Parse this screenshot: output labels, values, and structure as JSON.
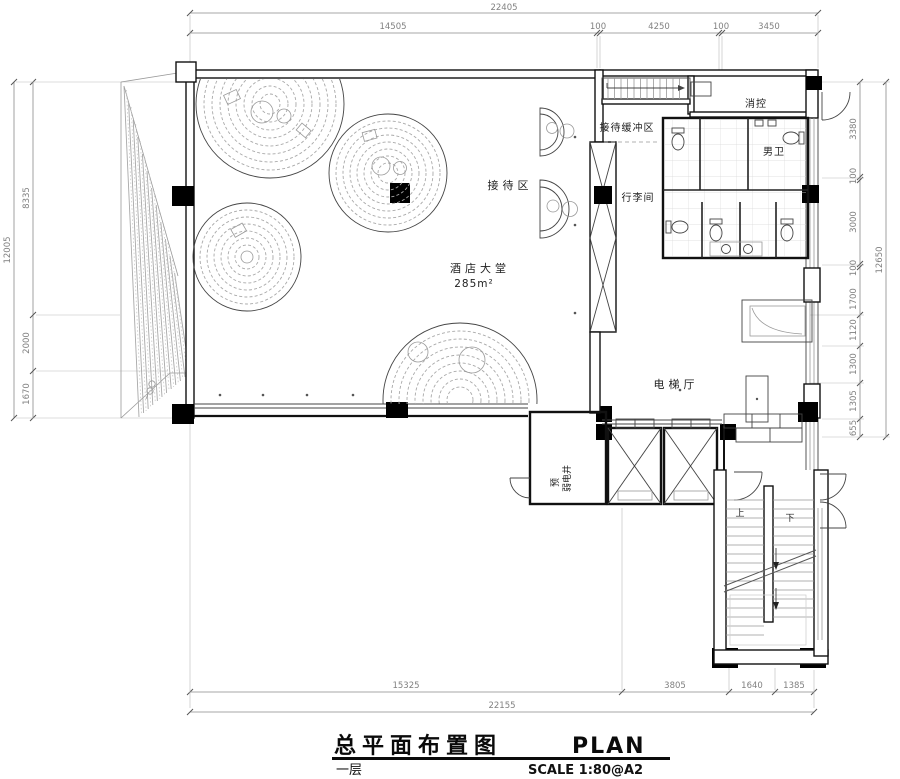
{
  "title_block": {
    "title_cn": "总平面布置图",
    "title_en": "PLAN",
    "floor_label": "一层",
    "scale_label": "SCALE  1:80@A2"
  },
  "rooms": {
    "lobby": "酒店大堂",
    "lobby_area": "285m²",
    "reception": "接待区",
    "reception_buffer": "接待缓冲区",
    "fire_control": "消控",
    "mens_toilet": "男卫",
    "luggage_room": "行李间",
    "elevator_hall": "电梯厅",
    "shaft_label": "弱电井",
    "shaft_label_prefix": "预",
    "stair_up": "上",
    "stair_down": "下"
  },
  "dimensions": {
    "top": {
      "total": "22405",
      "segments": [
        "14505",
        "100",
        "4250",
        "100",
        "3450"
      ]
    },
    "bottom": {
      "total": "22155",
      "segments": [
        "15325",
        "3805",
        "1640",
        "1385"
      ]
    },
    "left": {
      "total": "12005",
      "segments": [
        "8335",
        "2000",
        "1670"
      ]
    },
    "right": {
      "total": "12650",
      "segments": [
        "3380",
        "100",
        "3000",
        "100",
        "1700",
        "1120",
        "1300",
        "1305",
        "655"
      ]
    }
  },
  "colors": {
    "line": "#111111",
    "dim_text": "#808080",
    "pattern": "#a9a9a9",
    "column_fill": "#000000"
  }
}
